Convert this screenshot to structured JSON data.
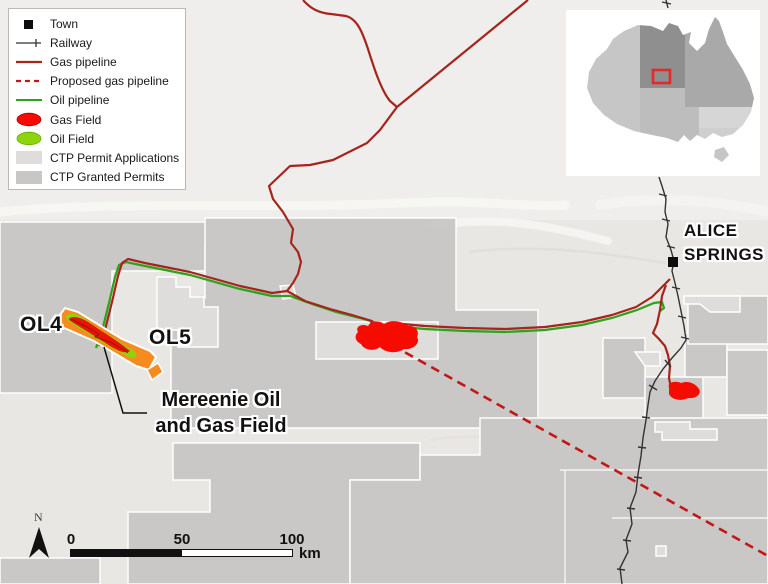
{
  "legend": {
    "items": [
      {
        "id": "town",
        "label": "Town"
      },
      {
        "id": "railway",
        "label": "Railway"
      },
      {
        "id": "gas-pipeline",
        "label": "Gas pipeline"
      },
      {
        "id": "proposed-gas-pipeline",
        "label": "Proposed gas pipeline"
      },
      {
        "id": "oil-pipeline",
        "label": "Oil pipeline"
      },
      {
        "id": "gas-field",
        "label": "Gas Field"
      },
      {
        "id": "oil-field",
        "label": "Oil Field"
      },
      {
        "id": "ctp-permit-applications",
        "label": "CTP Permit Applications"
      },
      {
        "id": "ctp-granted-permits",
        "label": "CTP Granted Permits"
      }
    ]
  },
  "map": {
    "labels": {
      "ol4": "OL4",
      "ol5": "OL5",
      "mereenie_line1": "Mereenie Oil",
      "mereenie_line2": "and Gas Field",
      "alice_line1": "ALICE",
      "alice_line2": "SPRINGS"
    }
  },
  "scalebar": {
    "tick0": "0",
    "tick50": "50",
    "tick100": "100",
    "unit": "km"
  },
  "north_label": "N",
  "colors": {
    "gas_pipeline": "#a5241c",
    "proposed_gas_pipeline": "#c21717",
    "oil_pipeline": "#2ea21b",
    "gas_field": "#f50b00",
    "oil_field": "#8ed40c",
    "mereenie_permit_orange": "#f78b1f",
    "ctp_applications": "#dedddb",
    "ctp_granted": "#c8c7c6",
    "railway": "#333333",
    "inset_highlight_box": "#e8262c"
  }
}
